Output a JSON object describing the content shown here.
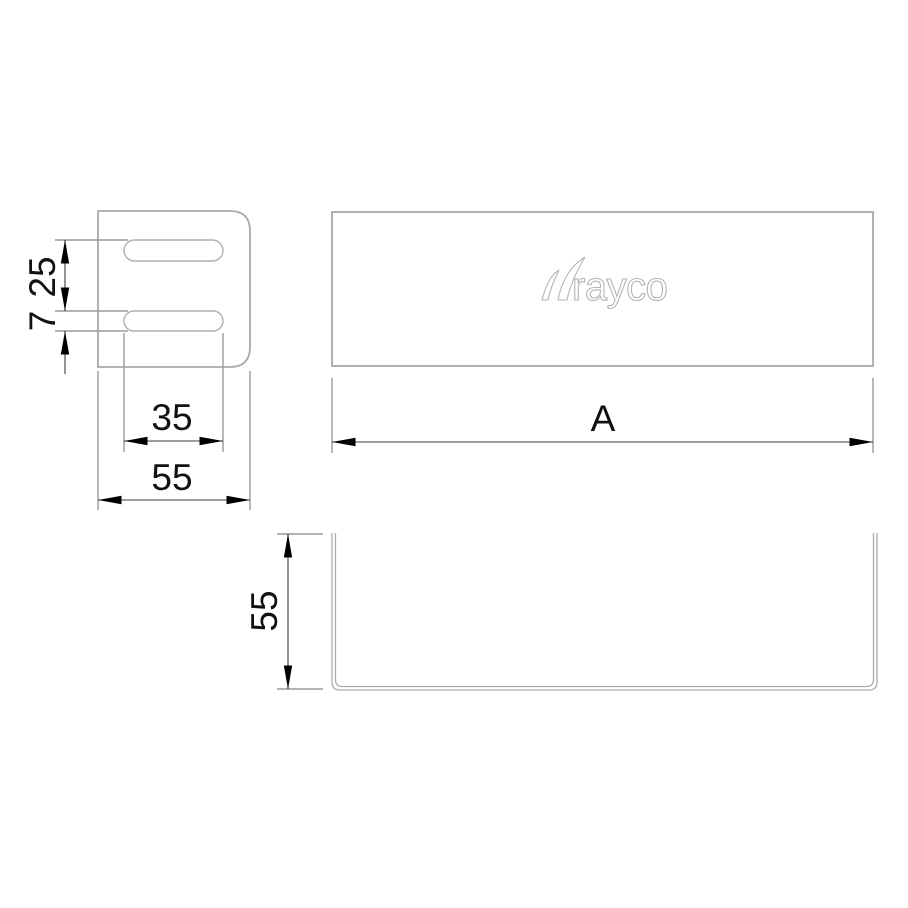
{
  "colors": {
    "background": "#ffffff",
    "view_outline": "#a9a9a9",
    "slot_outline": "#b0b0b0",
    "extension_line": "#9a9a9a",
    "dimension_line": "#3d3d3d",
    "arrowhead": "#000000",
    "dimension_text": "#111111",
    "logo_outline": "#b5b5b5"
  },
  "logo": {
    "full_text": "trayco",
    "letters_after_swoosh": "rayco"
  },
  "views": {
    "side": {
      "dims": {
        "slot_pitch": "25",
        "slot_height": "7",
        "slot_length": "35",
        "width": "55"
      }
    },
    "top": {
      "dims": {
        "length": "A"
      }
    },
    "front": {
      "dims": {
        "height": "55"
      }
    }
  }
}
